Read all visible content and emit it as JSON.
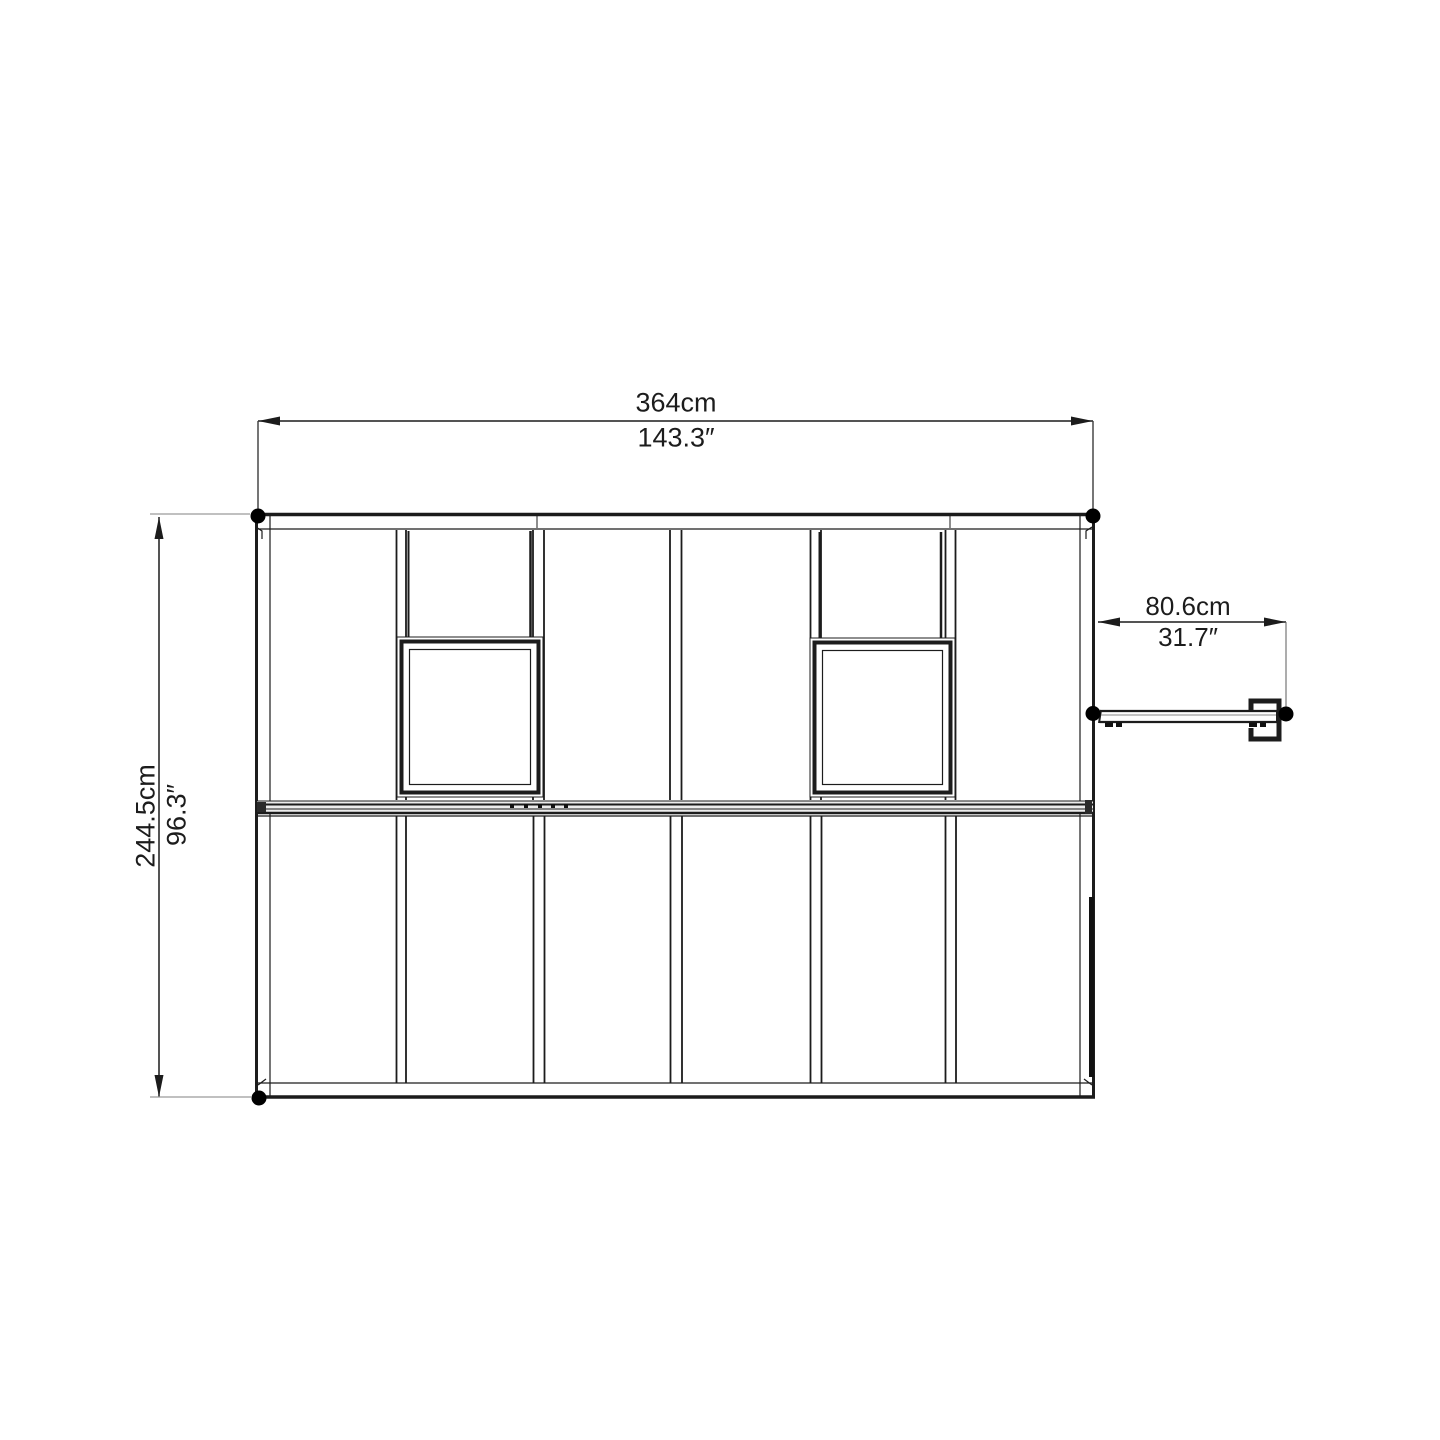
{
  "title": "Greenhouse top view dimension drawing",
  "colors": {
    "line": "#1c1c1c",
    "extension_line": "#9b9b9b",
    "connector_line": "#3a3a3a",
    "background": "#ffffff"
  },
  "dimensions": {
    "width": {
      "metric": "364cm",
      "imperial": "143.3″"
    },
    "depth": {
      "metric": "244.5cm",
      "imperial": "96.3″"
    },
    "door_extension": {
      "metric": "80.6cm",
      "imperial": "31.7″"
    }
  },
  "features": {
    "roof_panel_columns": 6,
    "roof_vents": 2,
    "anchor_dots": 5
  }
}
